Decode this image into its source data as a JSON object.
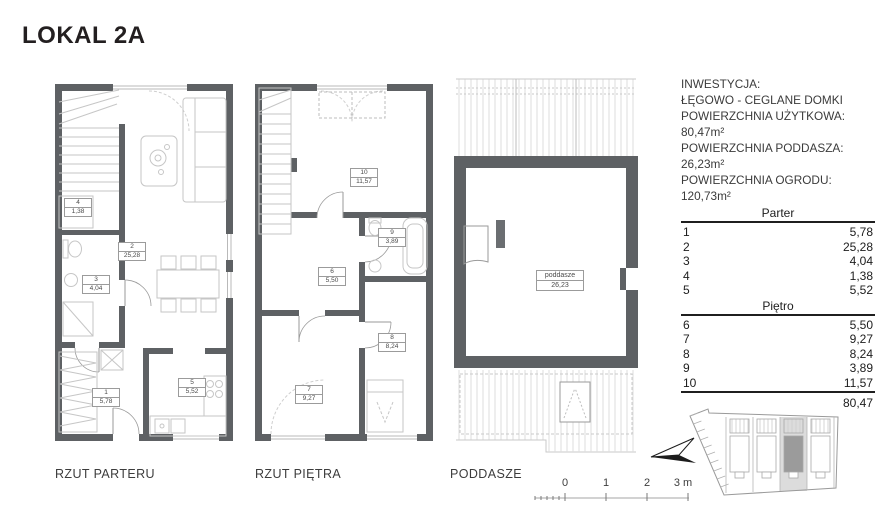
{
  "page": {
    "title": "LOKAL 2A"
  },
  "plans": {
    "parter": {
      "label": "RZUT PARTERU",
      "rooms": [
        {
          "number": "1",
          "area": "5,78"
        },
        {
          "number": "2",
          "area": "25,28"
        },
        {
          "number": "3",
          "area": "4,04"
        },
        {
          "number": "4",
          "area": "1,38"
        },
        {
          "number": "5",
          "area": "5,52"
        }
      ]
    },
    "pietro": {
      "label": "RZUT PIĘTRA",
      "rooms": [
        {
          "number": "6",
          "area": "5,50"
        },
        {
          "number": "7",
          "area": "9,27"
        },
        {
          "number": "8",
          "area": "8,24"
        },
        {
          "number": "9",
          "area": "3,89"
        },
        {
          "number": "10",
          "area": "11,57"
        }
      ]
    },
    "poddasze": {
      "label": "PODDASZE",
      "room": {
        "name": "poddasze",
        "area": "26,23"
      }
    }
  },
  "info": {
    "lines": [
      "INWESTYCJA:",
      "ŁĘGOWO - CEGLANE DOMKI",
      "POWIERZCHNIA UŻYTKOWA:",
      "80,47m²",
      "POWIERZCHNIA PODDASZA:",
      "26,23m²",
      "POWIERZCHNIA OGRODU:",
      "120,73m²"
    ]
  },
  "table": {
    "sections": [
      {
        "header": "Parter",
        "rows": [
          [
            "1",
            "5,78"
          ],
          [
            "2",
            "25,28"
          ],
          [
            "3",
            "4,04"
          ],
          [
            "4",
            "1,38"
          ],
          [
            "5",
            "5,52"
          ]
        ]
      },
      {
        "header": "Piętro",
        "rows": [
          [
            "6",
            "5,50"
          ],
          [
            "7",
            "9,27"
          ],
          [
            "8",
            "8,24"
          ],
          [
            "9",
            "3,89"
          ],
          [
            "10",
            "11,57"
          ]
        ]
      }
    ],
    "total": "80,47"
  },
  "scalebar": {
    "ticks": [
      "0",
      "1",
      "2",
      "3 m"
    ]
  },
  "colors": {
    "wall": "#5e6164",
    "furniture_line": "#c6c6c6",
    "text": "#231f20",
    "highlight_unit": "#9b9b9b"
  }
}
